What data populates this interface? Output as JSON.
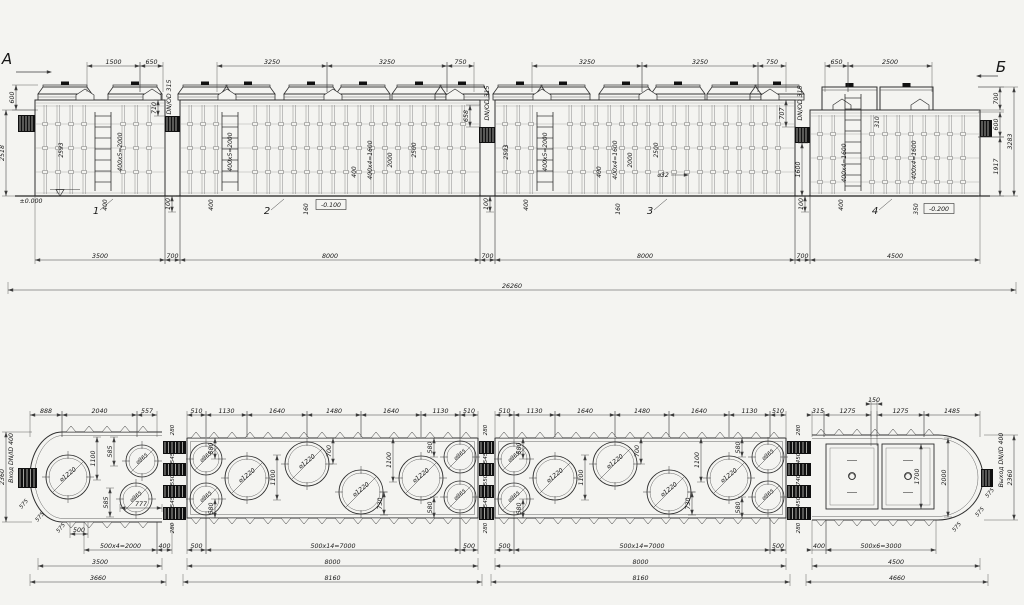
{
  "markers": {
    "left": "А",
    "right": "Б"
  },
  "labels": {
    "pipe_size": "DN/OD 315",
    "inlet": "Вход DN/ID 400",
    "outlet": "Выход DN/ID 400",
    "level_zero": "±0.000",
    "level_minus_100": "-0.100",
    "level_minus_200": "-0.200",
    "nozzle": "⌀32",
    "section_numbers": [
      "1",
      "2",
      "3",
      "4"
    ]
  },
  "hdims": [
    [
      "1500",
      87,
      140,
      66,
      26
    ],
    [
      "650",
      140,
      163,
      66,
      26
    ],
    [
      "3250",
      217,
      327,
      66,
      26
    ],
    [
      "3250",
      327,
      447,
      66,
      26
    ],
    [
      "750",
      447,
      474,
      66,
      26
    ],
    [
      "3250",
      532,
      642,
      66,
      26
    ],
    [
      "3250",
      642,
      758,
      66,
      26
    ],
    [
      "750",
      758,
      786,
      66,
      26
    ],
    [
      "650",
      825,
      848,
      66,
      26
    ],
    [
      "2500",
      848,
      932,
      66,
      26
    ],
    [
      "3500",
      35,
      165,
      260,
      -64
    ],
    [
      "700",
      165,
      180,
      260,
      -64
    ],
    [
      "8000",
      180,
      480,
      260,
      -64
    ],
    [
      "700",
      480,
      495,
      260,
      -64
    ],
    [
      "8000",
      495,
      795,
      260,
      -64
    ],
    [
      "700",
      795,
      810,
      260,
      -64
    ],
    [
      "4500",
      810,
      980,
      260,
      -64
    ],
    [
      "26260",
      8,
      1016,
      290,
      -8
    ],
    [
      "888",
      30,
      62,
      415,
      22
    ],
    [
      "2040",
      62,
      137,
      415,
      22
    ],
    [
      "557",
      137,
      157,
      415,
      22
    ],
    [
      "510",
      187,
      206,
      415,
      22
    ],
    [
      "1130",
      206,
      247,
      415,
      22
    ],
    [
      "1640",
      247,
      307,
      415,
      22
    ],
    [
      "1480",
      307,
      361,
      415,
      22
    ],
    [
      "1640",
      361,
      421,
      415,
      22
    ],
    [
      "1130",
      421,
      460,
      415,
      22
    ],
    [
      "510",
      460,
      478,
      415,
      22
    ],
    [
      "510",
      495,
      514,
      415,
      22
    ],
    [
      "1130",
      514,
      555,
      415,
      22
    ],
    [
      "1640",
      555,
      615,
      415,
      22
    ],
    [
      "1480",
      615,
      669,
      415,
      22
    ],
    [
      "1640",
      669,
      729,
      415,
      22
    ],
    [
      "1130",
      729,
      770,
      415,
      22
    ],
    [
      "510",
      770,
      786,
      415,
      22
    ],
    [
      "315",
      812,
      824,
      415,
      22
    ],
    [
      "1275",
      824,
      871,
      415,
      22
    ],
    [
      "1275",
      877,
      924,
      415,
      22
    ],
    [
      "1485",
      924,
      980,
      415,
      22
    ],
    [
      "150",
      871,
      877,
      404,
      42
    ],
    [
      "500",
      70,
      88,
      534,
      -12
    ],
    [
      "500x4=2000",
      84,
      157,
      550,
      -28
    ],
    [
      "400",
      157,
      172,
      550,
      -28
    ],
    [
      "500",
      187,
      206,
      550,
      -32
    ],
    [
      "500x14=7000",
      206,
      460,
      550,
      -32
    ],
    [
      "500",
      460,
      478,
      550,
      -32
    ],
    [
      "500",
      495,
      514,
      550,
      -32
    ],
    [
      "500x14=7000",
      514,
      770,
      550,
      -32
    ],
    [
      "500",
      770,
      786,
      550,
      -32
    ],
    [
      "400",
      812,
      826,
      550,
      -30
    ],
    [
      "500x6=3000",
      826,
      936,
      550,
      -30
    ],
    [
      "3500",
      38,
      162,
      566,
      -8
    ],
    [
      "8000",
      187,
      478,
      566,
      -8
    ],
    [
      "8000",
      495,
      786,
      566,
      -8
    ],
    [
      "4500",
      812,
      980,
      566,
      -8
    ],
    [
      "3660",
      30,
      166,
      582,
      -8
    ],
    [
      "8160",
      183,
      482,
      582,
      -8
    ],
    [
      "8160",
      491,
      790,
      582,
      -8
    ],
    [
      "4660",
      806,
      988,
      582,
      -8
    ],
    [
      "777",
      120,
      162,
      508
    ]
  ],
  "vdims": [
    [
      "600",
      16,
      85,
      110,
      22
    ],
    [
      "2518",
      6,
      110,
      196,
      30
    ],
    [
      "710",
      158,
      100,
      116,
      8
    ],
    [
      "658",
      470,
      105,
      127,
      10
    ],
    [
      "707",
      786,
      100,
      127,
      10
    ],
    [
      "700",
      1000,
      87,
      110,
      -22
    ],
    [
      "600",
      1000,
      112,
      137,
      -22
    ],
    [
      "1917",
      1000,
      137,
      196,
      -22
    ],
    [
      "3283",
      1014,
      87,
      196,
      -36
    ],
    [
      "1600",
      802,
      143,
      196,
      6
    ],
    [
      "100",
      172,
      196,
      212
    ],
    [
      "100",
      490,
      196,
      212
    ],
    [
      "100",
      805,
      196,
      212
    ],
    [
      "2360",
      6,
      432,
      522,
      26
    ],
    [
      "1100",
      97,
      437,
      480
    ],
    [
      "585",
      114,
      437,
      466
    ],
    [
      "585",
      110,
      488,
      517
    ],
    [
      "580",
      215,
      438,
      459
    ],
    [
      "580",
      215,
      499,
      518
    ],
    [
      "1100",
      277,
      455,
      500
    ],
    [
      "700",
      333,
      438,
      464
    ],
    [
      "1100",
      393,
      438,
      482
    ],
    [
      "730",
      384,
      492,
      515
    ],
    [
      "580",
      434,
      438,
      457
    ],
    [
      "580",
      434,
      497,
      518
    ],
    [
      "580",
      523,
      438,
      459
    ],
    [
      "580",
      523,
      499,
      518
    ],
    [
      "1100",
      585,
      455,
      500
    ],
    [
      "700",
      641,
      438,
      464
    ],
    [
      "1100",
      701,
      438,
      482
    ],
    [
      "730",
      692,
      492,
      515
    ],
    [
      "580",
      742,
      438,
      457
    ],
    [
      "580",
      742,
      497,
      518
    ],
    [
      "1700",
      921,
      444,
      509
    ],
    [
      "2000",
      948,
      438,
      517
    ],
    [
      "2360",
      1014,
      435,
      520,
      -30
    ]
  ],
  "notes": [
    [
      "2593",
      63,
      150
    ],
    [
      "400x5=2000",
      122,
      152
    ],
    [
      "400",
      107,
      205
    ],
    [
      "400x5=2000",
      232,
      152
    ],
    [
      "400",
      213,
      205
    ],
    [
      "400",
      356,
      172
    ],
    [
      "400x4=1600",
      372,
      160
    ],
    [
      "2000",
      392,
      160
    ],
    [
      "2500",
      416,
      150
    ],
    [
      "160",
      308,
      209
    ],
    [
      "2593",
      508,
      152
    ],
    [
      "400x5=2000",
      547,
      152
    ],
    [
      "400",
      528,
      205
    ],
    [
      "400",
      601,
      172
    ],
    [
      "400x4=1600",
      617,
      160
    ],
    [
      "2000",
      632,
      160
    ],
    [
      "2500",
      658,
      150
    ],
    [
      "160",
      620,
      209
    ],
    [
      "350",
      918,
      209
    ],
    [
      "310",
      879,
      122
    ],
    [
      "400x4=1600",
      846,
      163
    ],
    [
      "400x4=1600",
      916,
      160
    ],
    [
      "400",
      843,
      205
    ]
  ],
  "gap_chains": [
    {
      "x": 174,
      "values": [
        "280",
        "545",
        "550",
        "545",
        "280"
      ]
    },
    {
      "x": 487,
      "values": [
        "280",
        "545",
        "550",
        "545",
        "280"
      ]
    },
    {
      "x": 800,
      "values": [
        "280",
        "450",
        "740",
        "450",
        "280"
      ]
    }
  ],
  "diag_labels": [
    [
      "575",
      25,
      505
    ],
    [
      "575",
      41,
      518
    ],
    [
      "575",
      62,
      529
    ],
    [
      "575",
      958,
      528
    ],
    [
      "575",
      981,
      513
    ],
    [
      "575",
      991,
      494
    ]
  ],
  "free_labels": [
    {
      "t": "А",
      "x": 7,
      "y": 64,
      "kind": "marker",
      "name": "view-marker-a"
    },
    {
      "t": "Б",
      "x": 1001,
      "y": 72,
      "kind": "marker",
      "name": "view-marker-b"
    },
    {
      "t": "DN/OD 315",
      "x": 171,
      "y": 97,
      "r": -90,
      "name": "pipe-size-label"
    },
    {
      "t": "DN/OD 315",
      "x": 489,
      "y": 103,
      "r": -90,
      "name": "pipe-size-label"
    },
    {
      "t": "DN/OD 315",
      "x": 802,
      "y": 103,
      "r": -90,
      "name": "pipe-size-label"
    },
    {
      "t": "Вход DN/ID 400",
      "x": 13,
      "y": 458,
      "r": -90,
      "name": "inlet-label"
    },
    {
      "t": "Выход DN/ID 400",
      "x": 1003,
      "y": 460,
      "r": -90,
      "name": "outlet-label"
    },
    {
      "t": "±0.000",
      "x": 31,
      "y": 203,
      "name": "level-zero-label"
    },
    {
      "t": "-0.100",
      "x": 331,
      "y": 207,
      "box": true,
      "name": "level-minus-100-label"
    },
    {
      "t": "-0.200",
      "x": 939,
      "y": 211,
      "box": true,
      "name": "level-minus-200-label"
    },
    {
      "t": "⌀32",
      "x": 663,
      "y": 177,
      "name": "pipe-dia-label"
    },
    {
      "t": "1",
      "x": 96,
      "y": 214,
      "kind": "secnum",
      "name": "section-number-1"
    },
    {
      "t": "2",
      "x": 267,
      "y": 214,
      "kind": "secnum",
      "name": "section-number-2"
    },
    {
      "t": "3",
      "x": 650,
      "y": 214,
      "kind": "secnum",
      "name": "section-number-3"
    },
    {
      "t": "4",
      "x": 875,
      "y": 214,
      "kind": "secnum",
      "name": "section-number-4"
    }
  ],
  "plan_circles": [
    [
      68,
      477,
      22,
      "⌀1220"
    ],
    [
      142,
      461,
      16,
      "⌀965"
    ],
    [
      136,
      499,
      16,
      "⌀965"
    ],
    [
      206,
      459,
      16,
      "⌀965"
    ],
    [
      206,
      499,
      16,
      "⌀965"
    ],
    [
      247,
      478,
      22,
      "⌀1220"
    ],
    [
      307,
      464,
      22,
      "⌀1220"
    ],
    [
      361,
      492,
      22,
      "⌀1220"
    ],
    [
      421,
      478,
      22,
      "⌀1220"
    ],
    [
      460,
      457,
      16,
      "⌀965"
    ],
    [
      460,
      497,
      16,
      "⌀965"
    ],
    [
      514,
      459,
      16,
      "⌀965"
    ],
    [
      514,
      499,
      16,
      "⌀965"
    ],
    [
      555,
      478,
      22,
      "⌀1220"
    ],
    [
      615,
      464,
      22,
      "⌀1220"
    ],
    [
      669,
      492,
      22,
      "⌀1220"
    ],
    [
      729,
      478,
      22,
      "⌀1220"
    ],
    [
      768,
      457,
      16,
      "⌀965"
    ],
    [
      768,
      497,
      16,
      "⌀965"
    ],
    [
      852,
      476,
      3.5,
      ""
    ],
    [
      908,
      476,
      3.5,
      ""
    ]
  ]
}
